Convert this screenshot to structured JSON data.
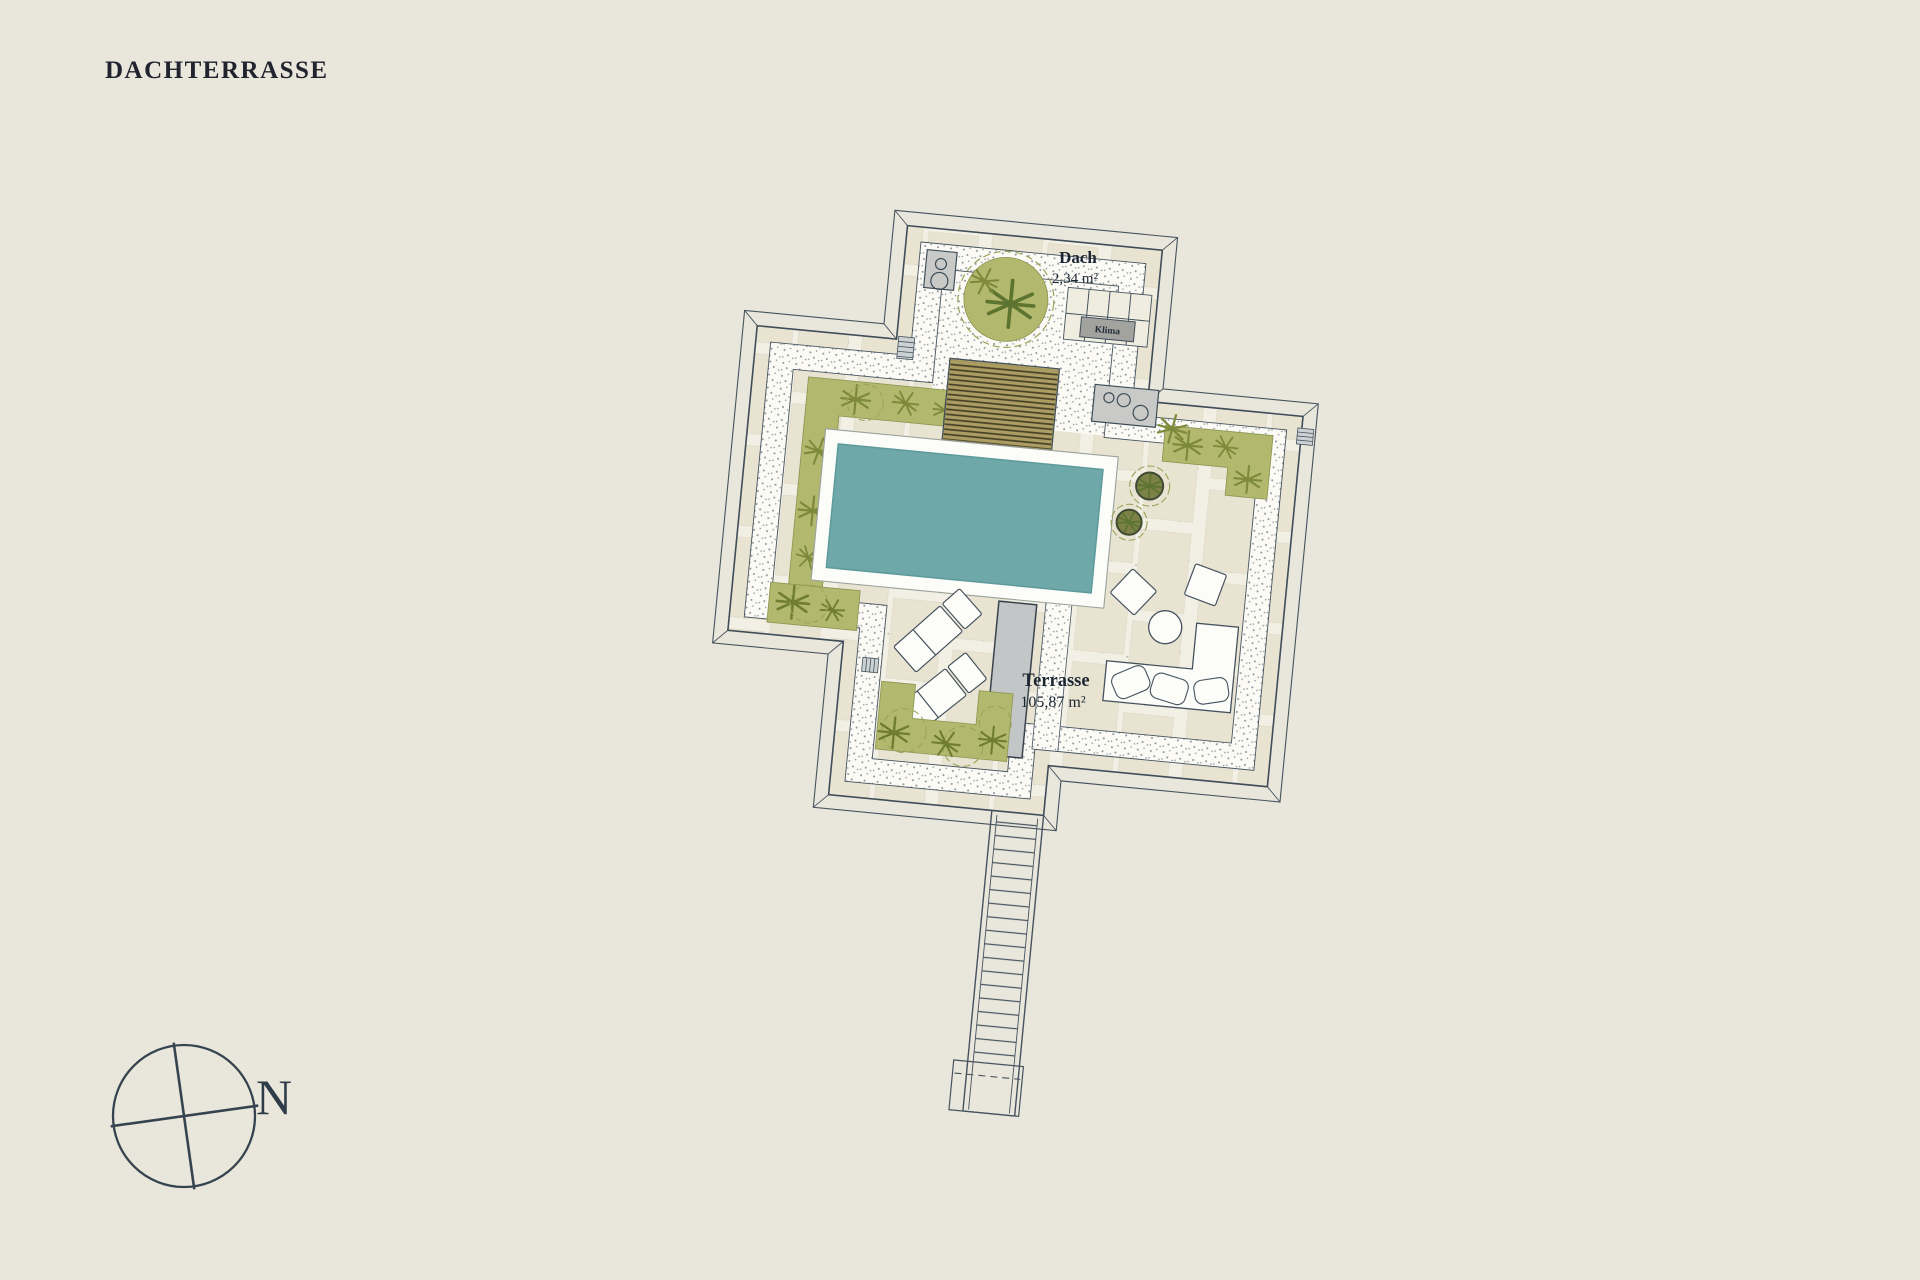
{
  "title": "DACHTERRASSE",
  "plan": {
    "rooms": {
      "dach": {
        "name": "Dach",
        "area": "2,34 m²"
      },
      "terrasse": {
        "name": "Terrasse",
        "area": "105,87 m²"
      }
    },
    "equipment": {
      "klima": "Klima"
    }
  },
  "compass": {
    "north": "N"
  },
  "colors": {
    "background": "#e9e6db",
    "line": "#46535f",
    "pool_water": "#6fa8a9",
    "pool_deck": "#fcfcf9",
    "planter_green": "#b2b86d",
    "wood_deck": "#ac9e62",
    "paver": "#e9e4d2",
    "gravel": "#fbfaf5",
    "equipment_grey": "#c9cac8"
  }
}
